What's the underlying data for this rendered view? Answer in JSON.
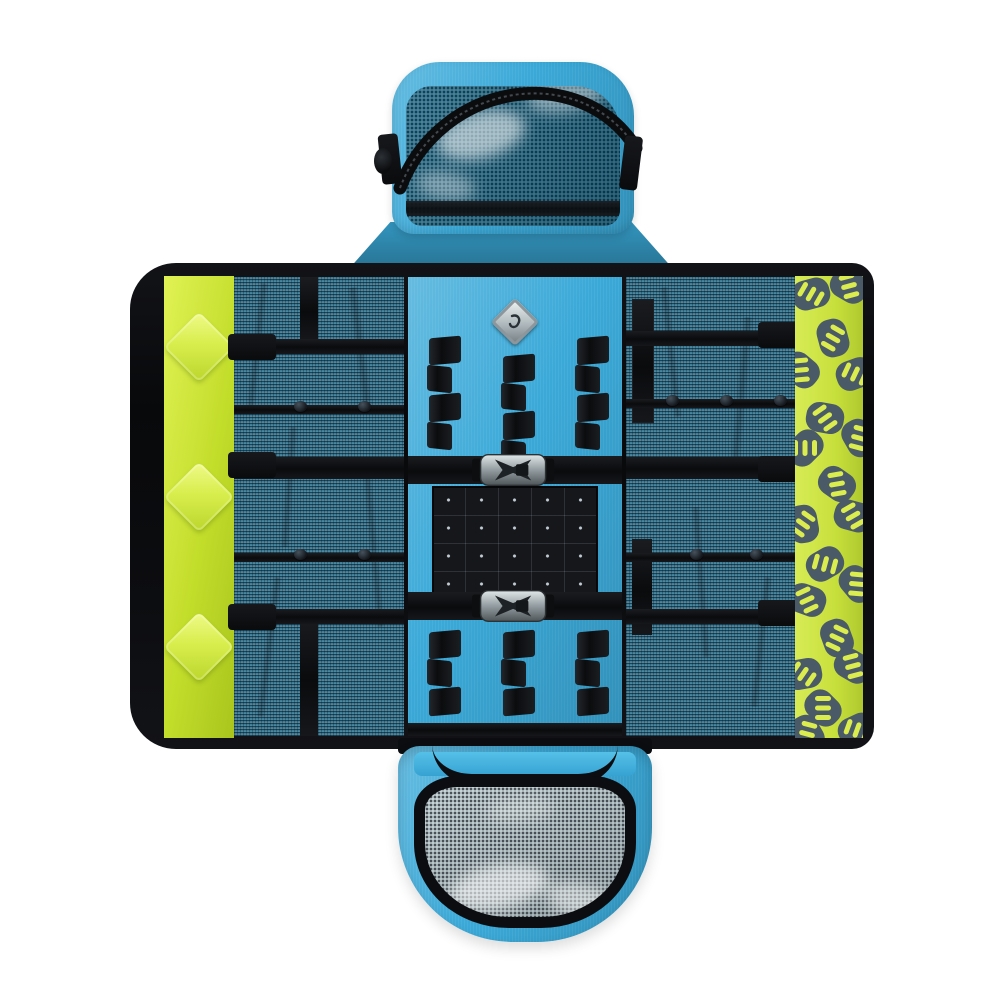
{
  "scene": {
    "subject": "Unfolded roll-up tool organizer bag with detachable zip pouches, photographed flat on white",
    "background_color": "#ffffff"
  },
  "colors": {
    "bg": "#ffffff",
    "blue-fabric": "#3aa9d8",
    "blue-light": "#55c1e8",
    "mesh-teal": "#3f7e99",
    "hi-vis-green": "#c3dd2b",
    "green-light": "#e0f254",
    "navy-logo": "#3b4c5b",
    "stripe-yellow": "#d8eb41",
    "black-trim": "#0c0d10",
    "silver": "#b9c2c6",
    "vinyl-grey": "#b7c8cd"
  },
  "components": {
    "top_pouch": {
      "mesh_window": true,
      "zipper": true,
      "side_tabs": 2,
      "bottom_webbing_bar": 1
    },
    "main_panel": {
      "reflective_diamonds": 3,
      "diamond_offsets_px": [
        46,
        196,
        346
      ],
      "elastic_loop_columns_top": 3,
      "segments_per_top_column": 4,
      "elastic_loop_columns_bottom": 3,
      "segments_per_bottom_column": 3,
      "buckles": 2,
      "snap_buttons": 9,
      "grid_panel": {
        "rows": 4,
        "cols": 5
      },
      "logo_patch": "diamond carabiner emblem",
      "brand_pattern_tiles": 20
    },
    "bottom_pouch": {
      "mesh_window": true,
      "handle": true
    }
  }
}
